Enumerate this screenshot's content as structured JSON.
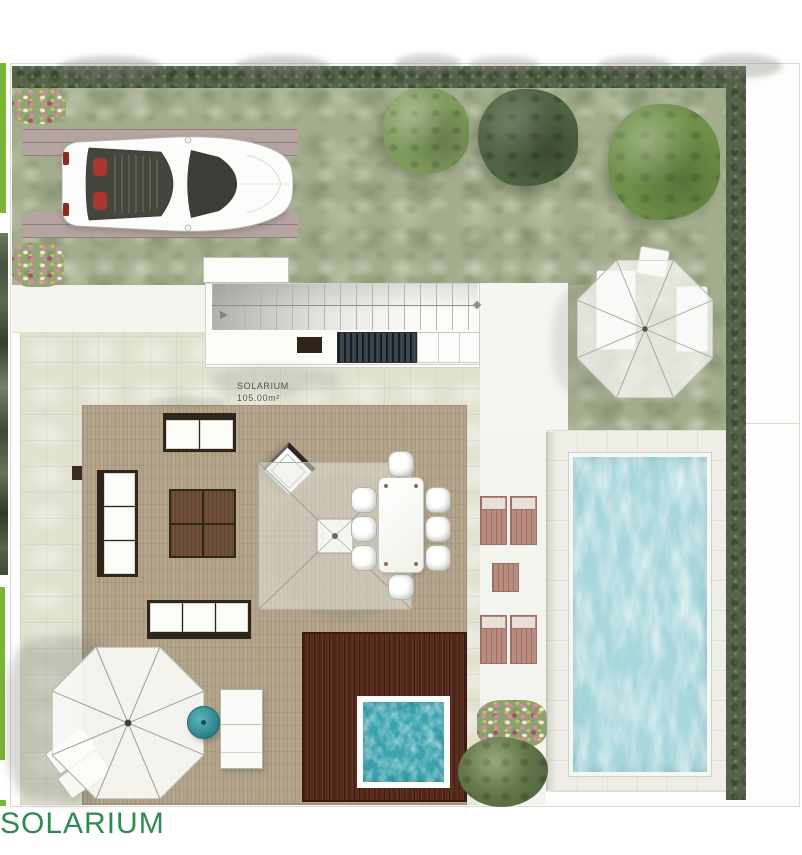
{
  "caption": {
    "text": "SOLARIUM"
  },
  "plan": {
    "label": {
      "title": "SOLARIUM",
      "area": "105.00m²"
    },
    "objects": [
      "sports-car",
      "parking-pavers",
      "flower-beds",
      "boxwood-hedge",
      "garden-trees",
      "staircase",
      "stair-landing",
      "vent-grill",
      "doormat",
      "storage-cabinets",
      "skylight",
      "pergola-parasol",
      "dining-table",
      "dining-chairs",
      "outdoor-sofa-set",
      "coffee-table",
      "wood-deck",
      "jacuzzi",
      "jacuzzi-deck",
      "patio-umbrella",
      "garden-umbrella",
      "sun-loungers",
      "teal-side-table",
      "swimming-pool",
      "pool-deck",
      "flower-bush"
    ]
  },
  "colors": {
    "accent_green": "#7ab636",
    "caption_green": "#2e8b51",
    "grass_green": "#a3ad8d",
    "hedge_green": "#55634a",
    "tile_floor": "#e1e1d0",
    "deck_wood": "#b3a489",
    "jacuzzi_deck_wood": "#56291b",
    "pool_water": "#a7d6dc",
    "jacuzzi_water": "#38a2ae",
    "pool_deck": "#eeeee6",
    "paving_brick": "#b5a4a1",
    "furniture_frame": "#2f2519",
    "coffee_table_wood": "#6f4f3b",
    "lounger_wood": "#b98c80",
    "side_table_teal": "#2f8792",
    "label_text": "#52524c"
  }
}
